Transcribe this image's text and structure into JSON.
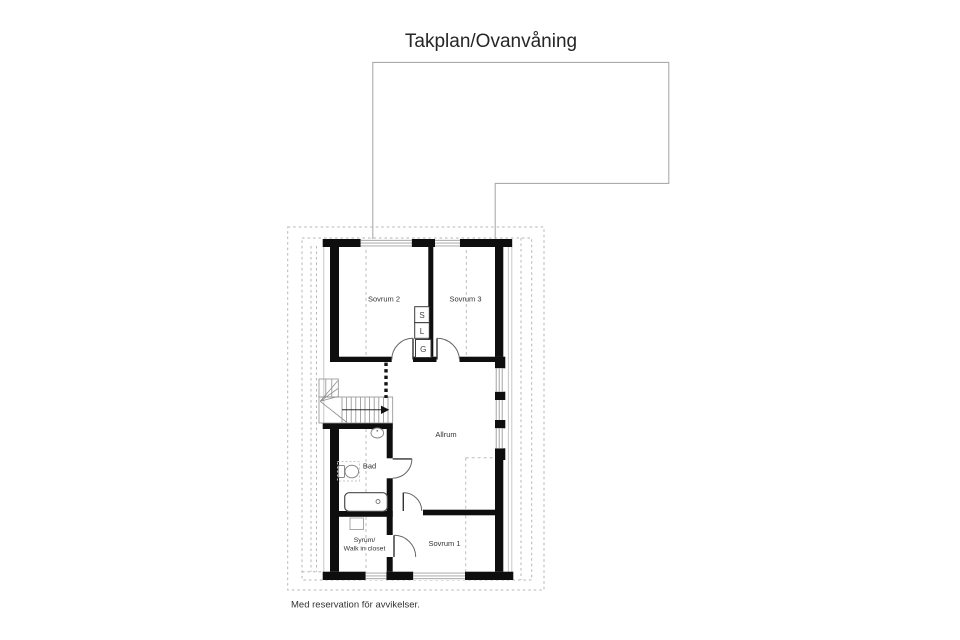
{
  "title": "Takplan/Ovanvåning",
  "disclaimer": "Med reservation för avvikelser.",
  "rooms": {
    "sovrum2": "Sovrum 2",
    "sovrum3": "Sovrum 3",
    "allrum": "Allrum",
    "bad": "Bad",
    "syrum_line1": "Syrum/",
    "syrum_line2": "Walk in closet",
    "sovrum1": "Sovrum 1"
  },
  "closet_labels": {
    "s": "S",
    "l": "L",
    "g": "G"
  },
  "colors": {
    "wall": "#0e0e0e",
    "window_line": "#9c9c9c",
    "guide_dash": "#b5b5b5",
    "roof_line": "#ababab",
    "fixture_line": "#8a8a8a",
    "text": "#333333",
    "title_text": "#262626"
  }
}
